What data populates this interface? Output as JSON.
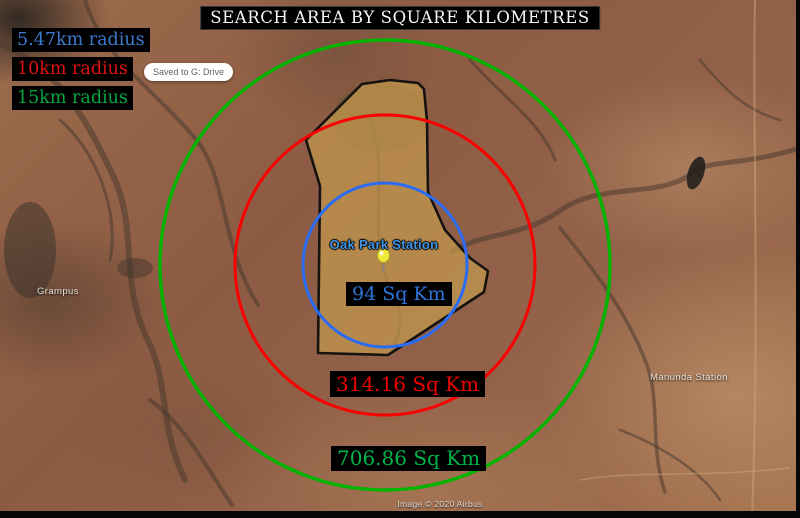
{
  "title": "SEARCH AREA BY SQUARE KILOMETRES",
  "legend": {
    "items": [
      {
        "label": "5.47km radius",
        "color": "#3c7ace"
      },
      {
        "label": "10km radius",
        "color": "#e01212"
      },
      {
        "label": "15km radius",
        "color": "#00a844"
      }
    ]
  },
  "toast": {
    "text": "Saved to G: Drive"
  },
  "placemark": {
    "label": "Oak Park Station",
    "label_color": "#4095e8",
    "pin_color": "#f2e93e"
  },
  "area_labels": [
    {
      "text": "94 Sq Km",
      "color": "#2f74d8"
    },
    {
      "text": "314.16 Sq Km",
      "color": "#ef0000"
    },
    {
      "text": "706.86 Sq Km",
      "color": "#00b44c"
    }
  ],
  "circles": [
    {
      "name": "5.47km radius circle",
      "color": "#2a6cf4"
    },
    {
      "name": "10km radius circle",
      "color": "#fa0000"
    },
    {
      "name": "15km radius circle",
      "color": "#00b400"
    }
  ],
  "region": {
    "name": "Oak Park Station property boundary",
    "fill": "#c79c4e"
  },
  "map_labels": [
    {
      "text": "Grampus"
    },
    {
      "text": "Manunda Station"
    }
  ],
  "attribution": "Image © 2020 Airbus"
}
